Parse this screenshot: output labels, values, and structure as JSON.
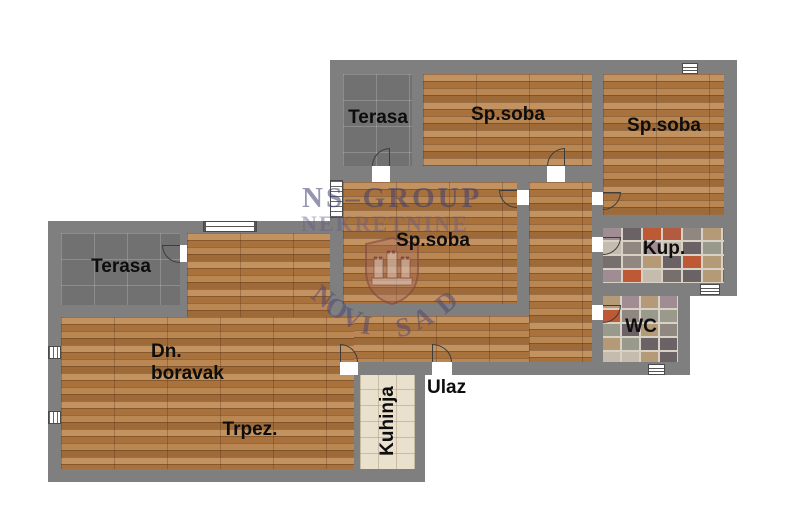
{
  "plan": {
    "rooms": [
      {
        "id": "terasa-top",
        "label": "Terasa"
      },
      {
        "id": "sp-soba-1",
        "label": "Sp.soba"
      },
      {
        "id": "sp-soba-2",
        "label": "Sp.soba"
      },
      {
        "id": "sp-soba-3",
        "label": "Sp.soba"
      },
      {
        "id": "kupatilo",
        "label": "Kup."
      },
      {
        "id": "wc",
        "label": "WC"
      },
      {
        "id": "terasa-bottom",
        "label": "Terasa"
      },
      {
        "id": "dnevni-boravak",
        "label": "Dn. boravak"
      },
      {
        "id": "trpezarija",
        "label": "Trpez."
      },
      {
        "id": "kuhinja",
        "label": "Kuhinja"
      },
      {
        "id": "ulaz",
        "label": "Ulaz"
      }
    ],
    "watermark": {
      "line1": "NS–GROUP",
      "line2": "NEKRETNINE",
      "city": "NOVI SAD"
    },
    "colors": {
      "wall": "#7f7f7f",
      "wood": "#b5824f",
      "terrace_tile": "#717171",
      "kitchen_tile": "#e9e1cd",
      "watermark": "#3e3e6e",
      "label_text": "#0d0d0d"
    }
  }
}
